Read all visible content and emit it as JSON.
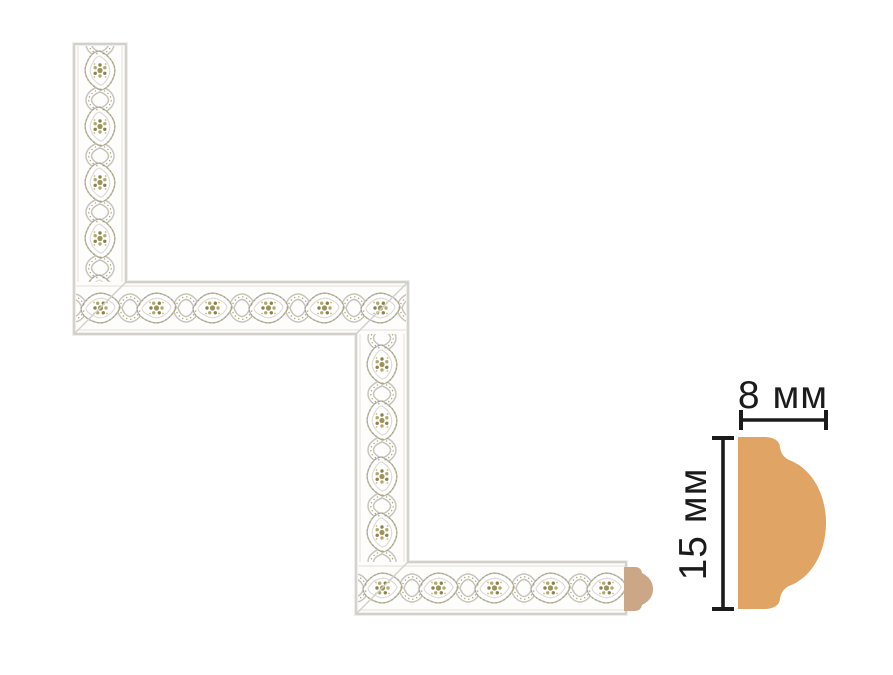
{
  "molding": {
    "base_color": "#fdfdfc",
    "outline_color": "#c8c6c0",
    "ornament_gold": "#a8a169",
    "end_cap_color": "#cba687"
  },
  "diagram": {
    "width_label": "8 мм",
    "height_label": "15 мм",
    "profile_fill": "#e0a464",
    "line_color": "#1b1b1b"
  }
}
